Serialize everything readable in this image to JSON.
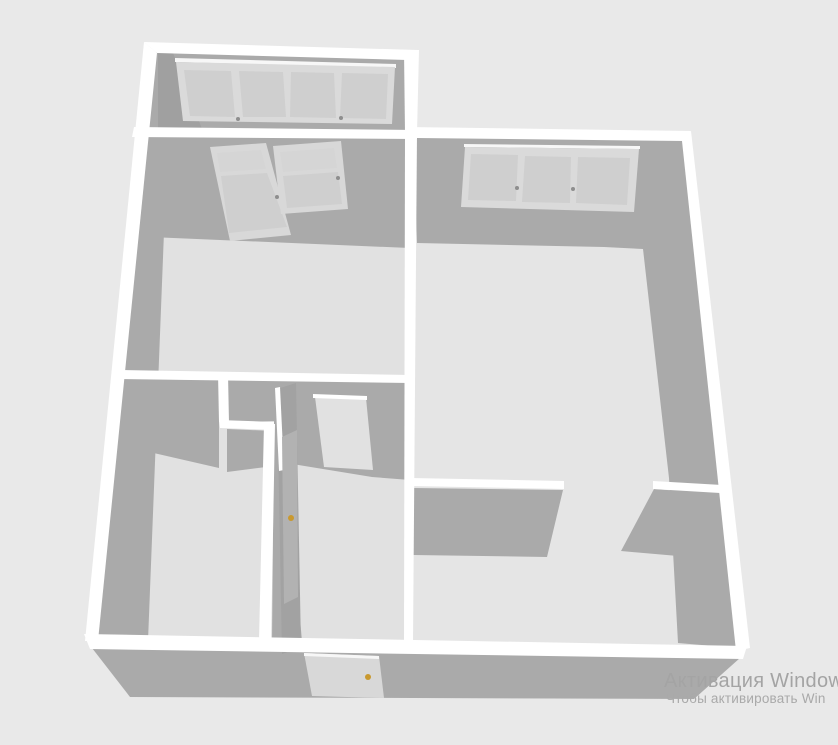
{
  "view": {
    "type": "floor-plan-3d-view",
    "rooms": [
      "balcony",
      "left-room",
      "right-room",
      "hallway",
      "closet"
    ],
    "objects": [
      "balcony-window-4-pane",
      "right-room-window-3-pane",
      "balcony-door",
      "balcony-side-window",
      "interior-door-open",
      "entrance-door",
      "kitchen-pass-through-stubs"
    ]
  },
  "colors": {
    "bg": "#e9e9e9",
    "wall_top": "#ffffff",
    "wall_face": "#aaaaaa",
    "wall_face_dark": "#a0a0a0",
    "floor_left": "#e1e1e1",
    "floor_right": "#e5e5e5",
    "window_frame": "#dadada",
    "window_glass": "#cfcfcf",
    "window_glass_light": "#d5d5d5",
    "window_highlight": "#f7f7f7",
    "door_leaf": "#a2a2a2",
    "door_panel": "#b2b2b2",
    "door_white": "#d8d8d8",
    "handle_gold": "#c9992f",
    "handle_gray": "#8e8e8e",
    "watermark_line1_color": "#a4a4a4",
    "watermark_line2_color": "#a9a9a9"
  },
  "watermark": {
    "line1": "Активация Windows",
    "line2": "Чтобы активировать Win"
  }
}
